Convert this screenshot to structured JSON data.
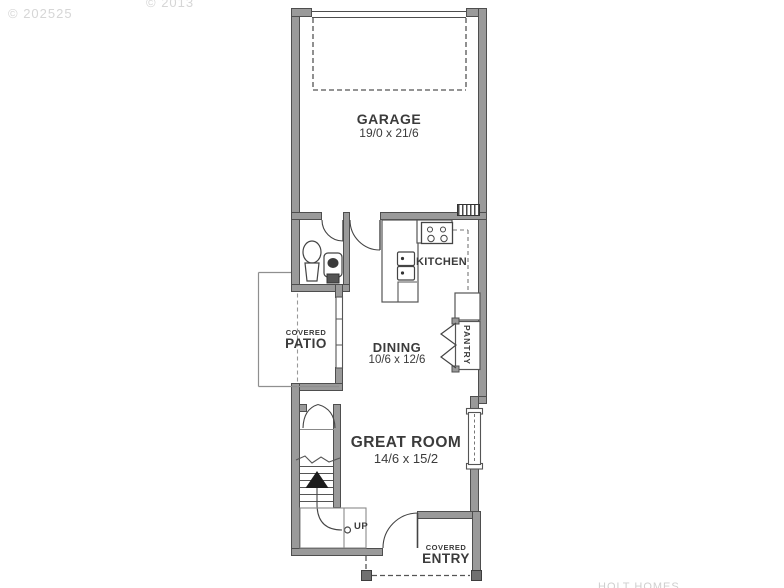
{
  "watermarks": {
    "top_left": "© 202525",
    "top_right": "© 2013",
    "bottom_right": "HOLT HOMES"
  },
  "rooms": {
    "garage": {
      "name": "GARAGE",
      "dims": "19/0 x 21/6"
    },
    "kitchen": {
      "name": "KITCHEN"
    },
    "dining": {
      "name": "DINING",
      "dims": "10/6 x 12/6"
    },
    "great_room": {
      "name": "GREAT ROOM",
      "dims": "14/6 x 15/2"
    },
    "pantry": {
      "name": "PANTRY"
    },
    "covered_patio": {
      "line1": "COVERED",
      "line2": "PATIO"
    },
    "covered_entry": {
      "line1": "COVERED",
      "line2": "ENTRY"
    },
    "stairs": {
      "direction_label": "UP"
    }
  },
  "colors": {
    "wall_fill": "#9a9a9a",
    "wall_edge": "#4e4e4e",
    "line": "#555555",
    "text": "#3b3b3b",
    "watermark": "#d6d6d6"
  }
}
